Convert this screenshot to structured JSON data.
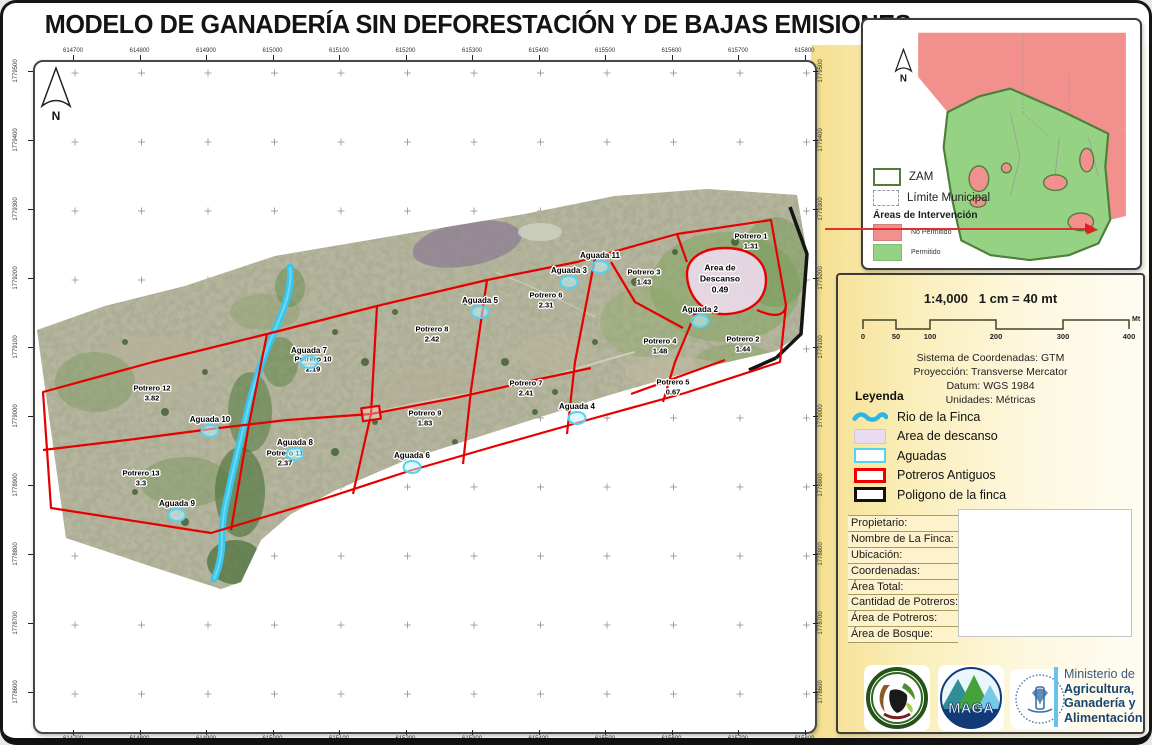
{
  "title": "MODELO DE GANADERÍA SIN DEFORESTACIÓN Y DE BAJAS EMISIONES",
  "map": {
    "north_label": "N",
    "x_ticks": [
      "614700",
      "614800",
      "614900",
      "615000",
      "615100",
      "615200",
      "615300",
      "615400",
      "615500",
      "615600",
      "615700",
      "615800"
    ],
    "y_ticks": [
      "1779500",
      "1779400",
      "1779300",
      "1779200",
      "1779100",
      "1779000",
      "1778900",
      "1778800",
      "1778700",
      "1778600"
    ],
    "potreros": [
      {
        "name": "Potrero 1",
        "area": "1.31",
        "x": 718,
        "y": 181
      },
      {
        "name": "Potrero 2",
        "area": "1.44",
        "x": 710,
        "y": 284
      },
      {
        "name": "Potrero 3",
        "area": "1.43",
        "x": 611,
        "y": 217
      },
      {
        "name": "Potrero 4",
        "area": "1.48",
        "x": 627,
        "y": 286
      },
      {
        "name": "Potrero 5",
        "area": "0.67",
        "x": 640,
        "y": 327
      },
      {
        "name": "Potrero 6",
        "area": "2.31",
        "x": 513,
        "y": 240
      },
      {
        "name": "Potrero 7",
        "area": "2.41",
        "x": 493,
        "y": 328
      },
      {
        "name": "Potrero 8",
        "area": "2.42",
        "x": 399,
        "y": 274
      },
      {
        "name": "Potrero 9",
        "area": "1.83",
        "x": 392,
        "y": 358
      },
      {
        "name": "Potrero 10",
        "area": "2.19",
        "x": 280,
        "y": 304
      },
      {
        "name": "Potrero 11",
        "area": "2.37",
        "x": 252,
        "y": 398
      },
      {
        "name": "Potrero 12",
        "area": "3.82",
        "x": 119,
        "y": 333
      },
      {
        "name": "Potrero 13",
        "area": "3.3",
        "x": 108,
        "y": 418
      }
    ],
    "aguadas": [
      {
        "name": "Aguada 2",
        "x": 667,
        "y": 250
      },
      {
        "name": "Aguada 3",
        "x": 536,
        "y": 211
      },
      {
        "name": "Aguada 4",
        "x": 544,
        "y": 347
      },
      {
        "name": "Aguada 5",
        "x": 447,
        "y": 241
      },
      {
        "name": "Aguada 6",
        "x": 379,
        "y": 396
      },
      {
        "name": "Aguada 7",
        "x": 276,
        "y": 291
      },
      {
        "name": "Aguada 8",
        "x": 262,
        "y": 383
      },
      {
        "name": "Aguada 9",
        "x": 144,
        "y": 444
      },
      {
        "name": "Aguada 10",
        "x": 177,
        "y": 360
      },
      {
        "name": "Aguada 11",
        "x": 567,
        "y": 196
      }
    ],
    "rest_area": {
      "line1": "Area de",
      "line2": "Descanso",
      "area": "0.49",
      "x": 687,
      "y": 219
    }
  },
  "inset": {
    "north_label": "N",
    "zam_label": "ZAM",
    "limite_label": "Límite Municipal",
    "areas_header": "Áreas de Intervención",
    "no_permitido": "No Permitido",
    "permitido": "Permitido",
    "colors": {
      "no_permitido": "#f2908d",
      "permitido": "#96d284",
      "zam_outline": "#4d7f3b"
    }
  },
  "scale_panel": {
    "ratio": "1:4,000",
    "equivalence": "1 cm = 40 mt",
    "bar_ticks": [
      "0",
      "50",
      "100",
      "200",
      "300",
      "400"
    ],
    "bar_unit": "Mt",
    "crs_lines": [
      "Sistema de Coordenadas: GTM",
      "Proyección: Transverse Mercator",
      "Datum: WGS 1984",
      "Unidades: Métricas"
    ]
  },
  "legend": {
    "header": "Leyenda",
    "items": [
      {
        "label": "Rio de la Finca",
        "type": "river"
      },
      {
        "label": "Area de descanso",
        "type": "rest"
      },
      {
        "label": "Aguadas",
        "type": "aguada"
      },
      {
        "label": "Potreros Antiguos",
        "type": "potrero"
      },
      {
        "label": "Poligono de la finca",
        "type": "poligono"
      }
    ]
  },
  "info_table": {
    "rows": [
      "Propietario:",
      "Nombre de La Finca:",
      "Ubicación:",
      "Coordenadas:",
      "Área Total:",
      "Cantidad de Potreros:",
      "Área de Potreros:",
      "Área de Bosque:"
    ]
  },
  "logos": {
    "maga_text": "MAGA",
    "ministry_lines": [
      "Ministerio de",
      "Agricultura,",
      "Ganadería y",
      "Alimentación"
    ]
  },
  "colors": {
    "potrero_line": "#e60000",
    "river": "#38c6ee",
    "aguada": "#55d2f0",
    "rest_fill": "#e8d9e8",
    "finca_line": "#151515",
    "accent_yellow": "#f5df8e"
  }
}
